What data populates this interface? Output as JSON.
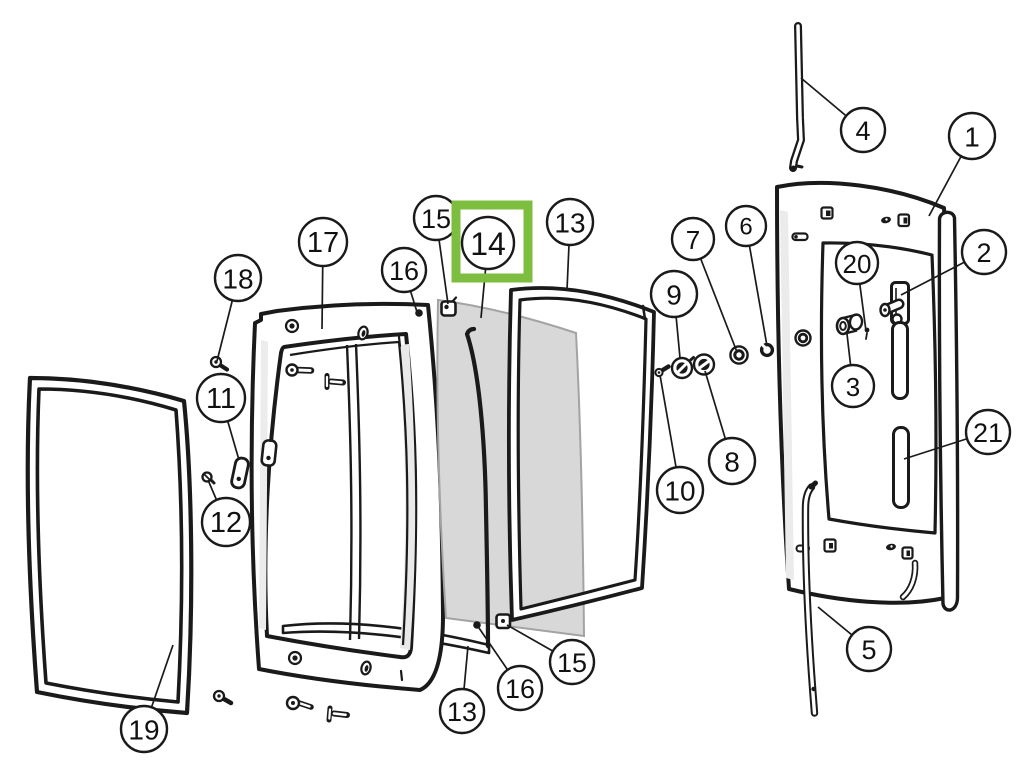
{
  "diagram": {
    "background": "#ffffff",
    "line_color": "#1a1a1a",
    "highlight": {
      "target_label": "14",
      "x": 456,
      "y": 205,
      "width": 72,
      "height": 73,
      "color": "#7DBE41",
      "stroke_width": 9
    },
    "callouts": [
      {
        "label": "1",
        "cx": 972,
        "cy": 136,
        "r": 23,
        "lx": 929,
        "ly": 216
      },
      {
        "label": "2",
        "cx": 984,
        "cy": 252,
        "r": 22,
        "lx": 901,
        "ly": 295
      },
      {
        "label": "3",
        "cx": 853,
        "cy": 386,
        "r": 21,
        "lx": 847,
        "ly": 334
      },
      {
        "label": "4",
        "cx": 863,
        "cy": 130,
        "r": 22,
        "lx": 801,
        "ly": 78
      },
      {
        "label": "5",
        "cx": 869,
        "cy": 649,
        "r": 22,
        "lx": 818,
        "ly": 607
      },
      {
        "label": "6",
        "cx": 746,
        "cy": 226,
        "r": 20,
        "lx": 767,
        "ly": 346
      },
      {
        "label": "7",
        "cx": 693,
        "cy": 239,
        "r": 21,
        "lx": 737,
        "ly": 352
      },
      {
        "label": "8",
        "cx": 732,
        "cy": 461,
        "r": 23,
        "lx": 705,
        "ly": 371
      },
      {
        "label": "9",
        "cx": 674,
        "cy": 294,
        "r": 23,
        "lx": 680,
        "ly": 358
      },
      {
        "label": "10",
        "cx": 680,
        "cy": 490,
        "r": 23,
        "lx": 660,
        "ly": 375
      },
      {
        "label": "11",
        "cx": 221,
        "cy": 398,
        "r": 24,
        "lx": 239,
        "ly": 460
      },
      {
        "label": "12",
        "cx": 226,
        "cy": 522,
        "r": 24,
        "lx": 208,
        "ly": 480
      },
      {
        "label": "13",
        "cx": 570,
        "cy": 222,
        "r": 23,
        "lx": 567,
        "ly": 290
      },
      {
        "label": "13",
        "cx": 462,
        "cy": 711,
        "r": 22,
        "lx": 468,
        "ly": 646
      },
      {
        "label": "14",
        "cx": 488,
        "cy": 243,
        "r": 26,
        "lx": 481,
        "ly": 318
      },
      {
        "label": "15",
        "cx": 436,
        "cy": 218,
        "r": 22,
        "lx": 448,
        "ly": 304
      },
      {
        "label": "15",
        "cx": 572,
        "cy": 662,
        "r": 22,
        "lx": 507,
        "ly": 625
      },
      {
        "label": "16",
        "cx": 404,
        "cy": 270,
        "r": 22,
        "lx": 417,
        "ly": 312
      },
      {
        "label": "16",
        "cx": 520,
        "cy": 688,
        "r": 22,
        "lx": 479,
        "ly": 628
      },
      {
        "label": "17",
        "cx": 323,
        "cy": 242,
        "r": 24,
        "lx": 322,
        "ly": 329
      },
      {
        "label": "18",
        "cx": 238,
        "cy": 278,
        "r": 23,
        "lx": 217,
        "ly": 361
      },
      {
        "label": "19",
        "cx": 144,
        "cy": 729,
        "r": 23,
        "lx": 173,
        "ly": 645
      },
      {
        "label": "20",
        "cx": 857,
        "cy": 263,
        "r": 21,
        "lx": 866,
        "ly": 331
      },
      {
        "label": "21",
        "cx": 988,
        "cy": 432,
        "r": 22,
        "lx": 904,
        "ly": 459
      }
    ]
  }
}
